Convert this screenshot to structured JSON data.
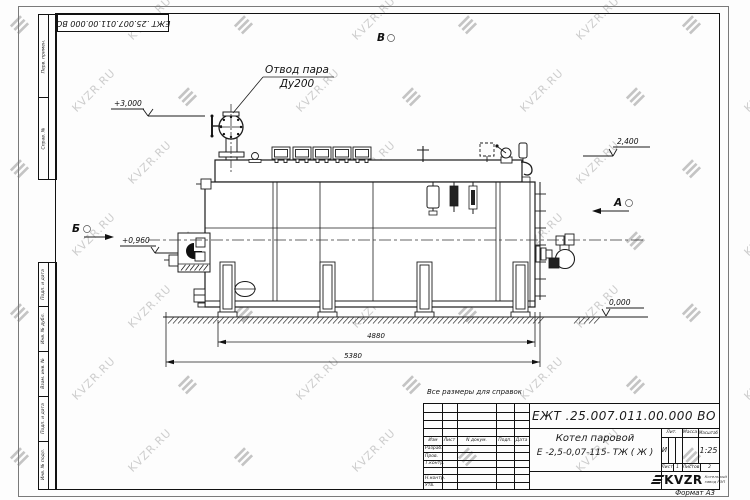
{
  "doc_number": "ЕЖТ .25.007.011.00.000  ВО",
  "watermark": {
    "text": "KVZR.RU",
    "logo_glyph": "≡"
  },
  "margin_stamp": {
    "top": [
      "Перв. примен.",
      "Справ. №"
    ],
    "bottom": [
      "Подп. и дата",
      "Инв. № дубл.",
      "Взам. инв. №",
      "Подп. и дата",
      "Инв. № подл."
    ]
  },
  "annotations": {
    "steam_outlet_line1": "Отвод пара",
    "steam_outlet_line2": "Ду200",
    "elev_top_left": "+3,000",
    "elev_deck": "2,400",
    "elev_burner": "+0,960",
    "elev_ground": "0,000",
    "dim_inner": "4880",
    "dim_overall": "5380",
    "view_top": "В",
    "view_right": "А",
    "view_left": "Б",
    "note": "Все размеры для справок"
  },
  "title_block": {
    "columns": {
      "izm": "Изм",
      "list": "Лист",
      "doc": "N докум.",
      "sign": "Подп.",
      "date": "Дата"
    },
    "rows": {
      "developed": "Разраб.",
      "checked": "Пров.",
      "tcontrol": "Т.контр.",
      "ncontrol": "Н.контр.",
      "approved": "Утв."
    },
    "product_line1": "Котел паровой",
    "product_line2": "Е -2,5-0,07-115- ТЖ ( Ж )",
    "lit_label": "Лит.",
    "lit_value": "И",
    "mass_label": "Масса",
    "scale_label": "Масштаб",
    "scale_value": "1:25",
    "sheet_label": "Лист",
    "sheet_value": "1",
    "sheets_label": "Листов",
    "sheets_value": "2",
    "logo_text": "KVZR",
    "logo_sub1": "Котельный",
    "logo_sub2": "завод РЭП",
    "format_label": "Формат А3"
  }
}
